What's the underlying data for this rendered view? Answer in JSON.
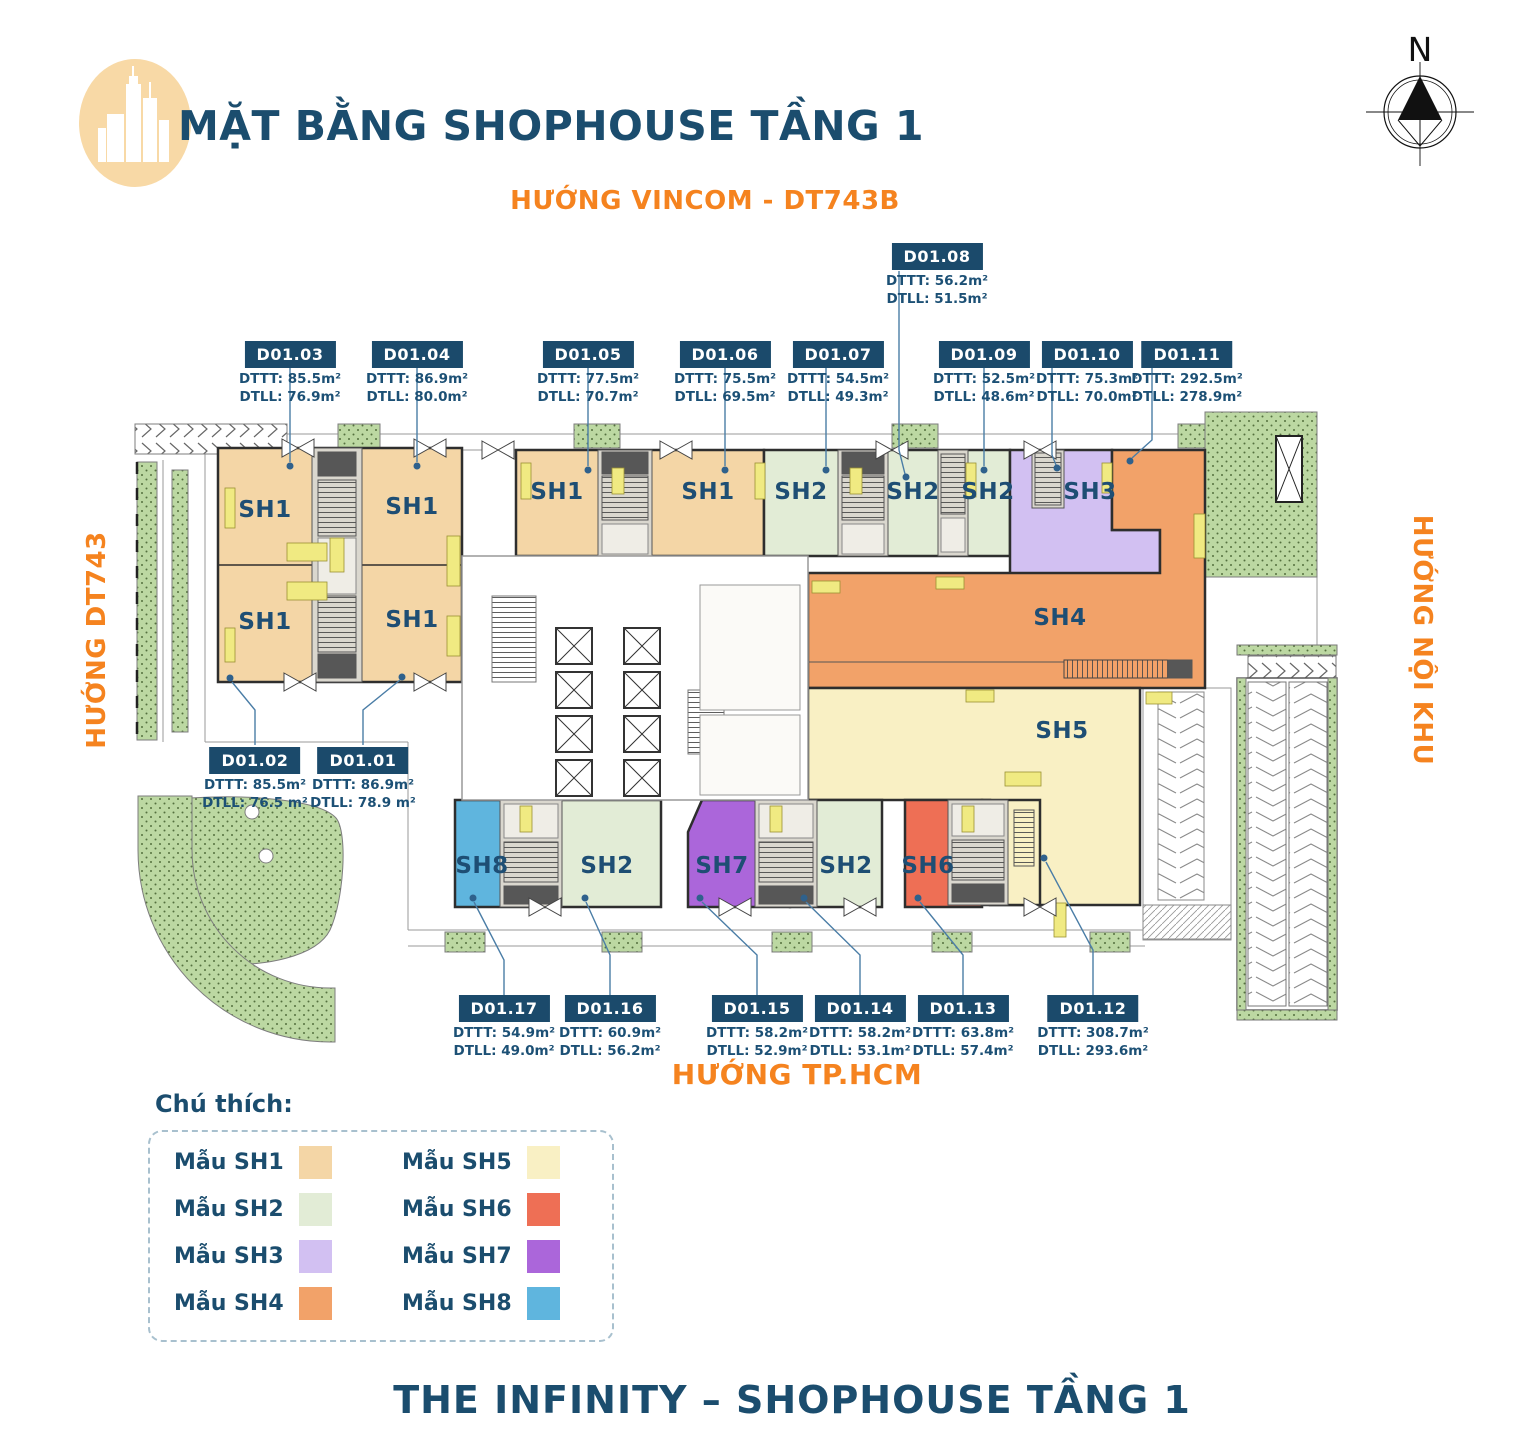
{
  "header": {
    "title": "MẶT BẰNG SHOPHOUSE TẦNG 1"
  },
  "compass": {
    "label": "N"
  },
  "directions": {
    "top": "HƯỚNG VINCOM - DT743B",
    "left": "HƯỚNG DT743",
    "right": "HƯỚNG NỘI KHU",
    "bottom": "HƯỚNG TP.HCM"
  },
  "plan": {
    "colors": {
      "sh1": "#f4d6a6",
      "sh2": "#e2ecd6",
      "sh3": "#d2c0f2",
      "sh4": "#f2a269",
      "sh5": "#f9f0c4",
      "sh6": "#ee6f55",
      "sh7": "#ab66da",
      "sh8": "#5fb5de"
    },
    "sh_labels": [
      {
        "text": "SH1"
      },
      {
        "text": "SH1"
      },
      {
        "text": "SH1"
      },
      {
        "text": "SH1"
      },
      {
        "text": "SH1"
      },
      {
        "text": "SH1"
      },
      {
        "text": "SH2"
      },
      {
        "text": "SH2"
      },
      {
        "text": "SH2"
      },
      {
        "text": "SH3"
      },
      {
        "text": "SH4"
      },
      {
        "text": "SH5"
      },
      {
        "text": "SH8"
      },
      {
        "text": "SH2"
      },
      {
        "text": "SH7"
      },
      {
        "text": "SH2"
      },
      {
        "text": "SH6"
      }
    ]
  },
  "units": [
    {
      "id": "D01.01",
      "dttt": "DTTT: 86.9m²",
      "dtll": "DTLL: 78.9 m²"
    },
    {
      "id": "D01.02",
      "dttt": "DTTT: 85.5m²",
      "dtll": "DTLL: 76.5 m²"
    },
    {
      "id": "D01.03",
      "dttt": "DTTT: 85.5m²",
      "dtll": "DTLL: 76.9m²"
    },
    {
      "id": "D01.04",
      "dttt": "DTTT: 86.9m²",
      "dtll": "DTLL: 80.0m²"
    },
    {
      "id": "D01.05",
      "dttt": "DTTT: 77.5m²",
      "dtll": "DTLL: 70.7m²"
    },
    {
      "id": "D01.06",
      "dttt": "DTTT: 75.5m²",
      "dtll": "DTLL: 69.5m²"
    },
    {
      "id": "D01.07",
      "dttt": "DTTT: 54.5m²",
      "dtll": "DTLL: 49.3m²"
    },
    {
      "id": "D01.08",
      "dttt": "DTTT: 56.2m²",
      "dtll": "DTLL: 51.5m²"
    },
    {
      "id": "D01.09",
      "dttt": "DTTT: 52.5m²",
      "dtll": "DTLL: 48.6m²"
    },
    {
      "id": "D01.10",
      "dttt": "DTTT: 75.3m²",
      "dtll": "DTLL: 70.0m²"
    },
    {
      "id": "D01.11",
      "dttt": "DTTT: 292.5m²",
      "dtll": "DTLL: 278.9m²"
    },
    {
      "id": "D01.12",
      "dttt": "DTTT: 308.7m²",
      "dtll": "DTLL: 293.6m²"
    },
    {
      "id": "D01.13",
      "dttt": "DTTT: 63.8m²",
      "dtll": "DTLL: 57.4m²"
    },
    {
      "id": "D01.14",
      "dttt": "DTTT: 58.2m²",
      "dtll": "DTLL: 53.1m²"
    },
    {
      "id": "D01.15",
      "dttt": "DTTT: 58.2m²",
      "dtll": "DTLL: 52.9m²"
    },
    {
      "id": "D01.16",
      "dttt": "DTTT: 60.9m²",
      "dtll": "DTLL: 56.2m²"
    },
    {
      "id": "D01.17",
      "dttt": "DTTT: 54.9m²",
      "dtll": "DTLL: 49.0m²"
    }
  ],
  "legend": {
    "title": "Chú thích:",
    "items": [
      {
        "label": "Mẫu SH1",
        "color": "#f4d6a6"
      },
      {
        "label": "Mẫu SH2",
        "color": "#e2ecd6"
      },
      {
        "label": "Mẫu SH3",
        "color": "#d2c0f2"
      },
      {
        "label": "Mẫu SH4",
        "color": "#f2a269"
      },
      {
        "label": "Mẫu SH5",
        "color": "#f9f0c4"
      },
      {
        "label": "Mẫu SH6",
        "color": "#ee6f55"
      },
      {
        "label": "Mẫu SH7",
        "color": "#ab66da"
      },
      {
        "label": "Mẫu SH8",
        "color": "#5fb5de"
      }
    ]
  },
  "footer": {
    "title": "THE INFINITY – SHOPHOUSE TẦNG 1"
  }
}
